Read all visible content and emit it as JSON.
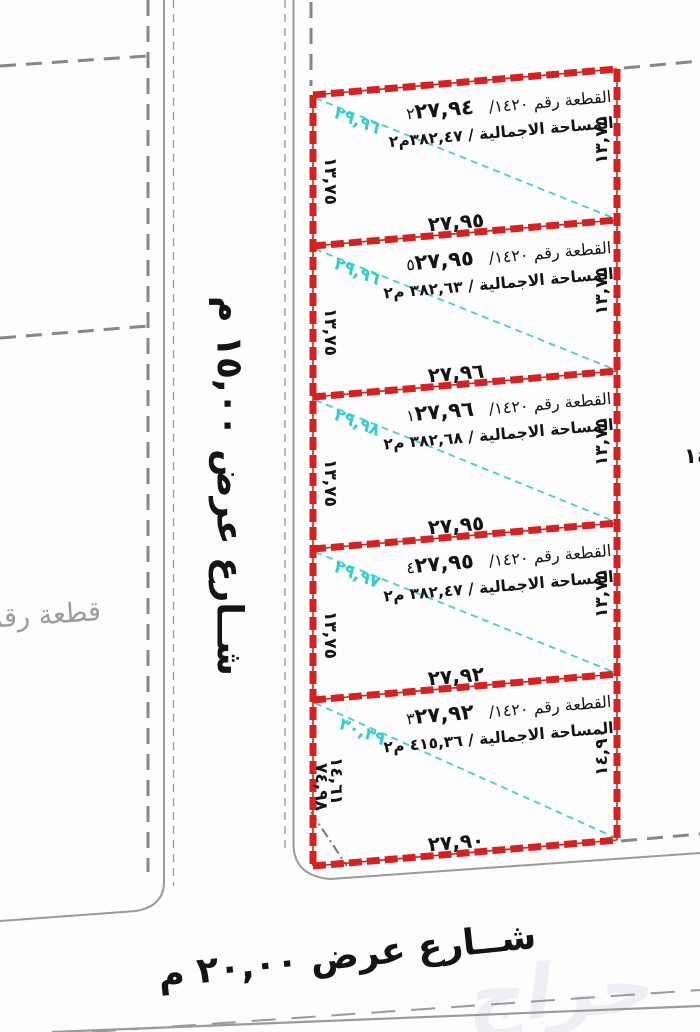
{
  "title": "مخطط قطع أراضي",
  "streets": {
    "left_street_label": "شــارع عرض ١٥,٠٠ م",
    "bottom_street_label": "شــارع عرض ٢٠,٠٠ م"
  },
  "neighbor": {
    "left_parcel_label": "قطعة رقم",
    "right_edge_partial_dim": "١٤"
  },
  "watermark": "حراج",
  "colors": {
    "plot_border": "#d92020",
    "diagonal_line": "#3ed3cf",
    "neighbor_line": "#878787",
    "street_line": "#9a9a9a"
  },
  "plots": [
    {
      "name_label": "القطعة رقم ١٤٢٠/ ٢",
      "top_dim": "٢٧,٩٤",
      "area_label": "المساحة الاجمالية / ٣٨٢,٤٧م٢",
      "left_dim": "١٣,٧٥",
      "right_dim": "١٣,٧٥",
      "diagonal_dim": "٢٩,٩٦",
      "bottom_dim": "٢٧,٩٥"
    },
    {
      "name_label": "القطعة رقم ١٤٢٠/ ٥",
      "top_dim": "٢٧,٩٥",
      "area_label": "المساحة الاجمالية / ٣٨٢,٦٣ م٢",
      "left_dim": "١٣,٧٥",
      "right_dim": "١٣,٧٥",
      "diagonal_dim": "٢٩,٩٦",
      "bottom_dim": "٢٧,٩٦"
    },
    {
      "name_label": "القطعة رقم ١٤٢٠/ ١",
      "top_dim": "٢٧,٩٦",
      "area_label": "المساحة الاجمالية / ٣٨٢,٦٨ م٢",
      "left_dim": "١٣,٧٥",
      "right_dim": "١٣,٧٥",
      "diagonal_dim": "٢٩,٩٨",
      "bottom_dim": "٢٧,٩٥"
    },
    {
      "name_label": "القطعة رقم ١٤٢٠/ ٤",
      "top_dim": "٢٧,٩٥",
      "area_label": "المساحة الاجمالية / ٣٨٢,٤٧ م٢",
      "left_dim": "١٣,٧٥",
      "right_dim": "١٣,٧٥",
      "diagonal_dim": "٢٩,٩٧",
      "bottom_dim": "٢٧,٩٢"
    },
    {
      "name_label": "القطعة رقم ١٤٢٠/ ٣",
      "top_dim": "٢٧,٩٢",
      "area_label": "المساحة الاجمالية / ٤١٥,٣٦ م٢",
      "left_dim": "١٤,٦١",
      "left_dim2": "٧٤,٩٨",
      "right_dim": "١٤,٩٠",
      "diagonal_dim": "٣٠,٣٩",
      "bottom_dim": "٢٧,٩٠"
    }
  ]
}
